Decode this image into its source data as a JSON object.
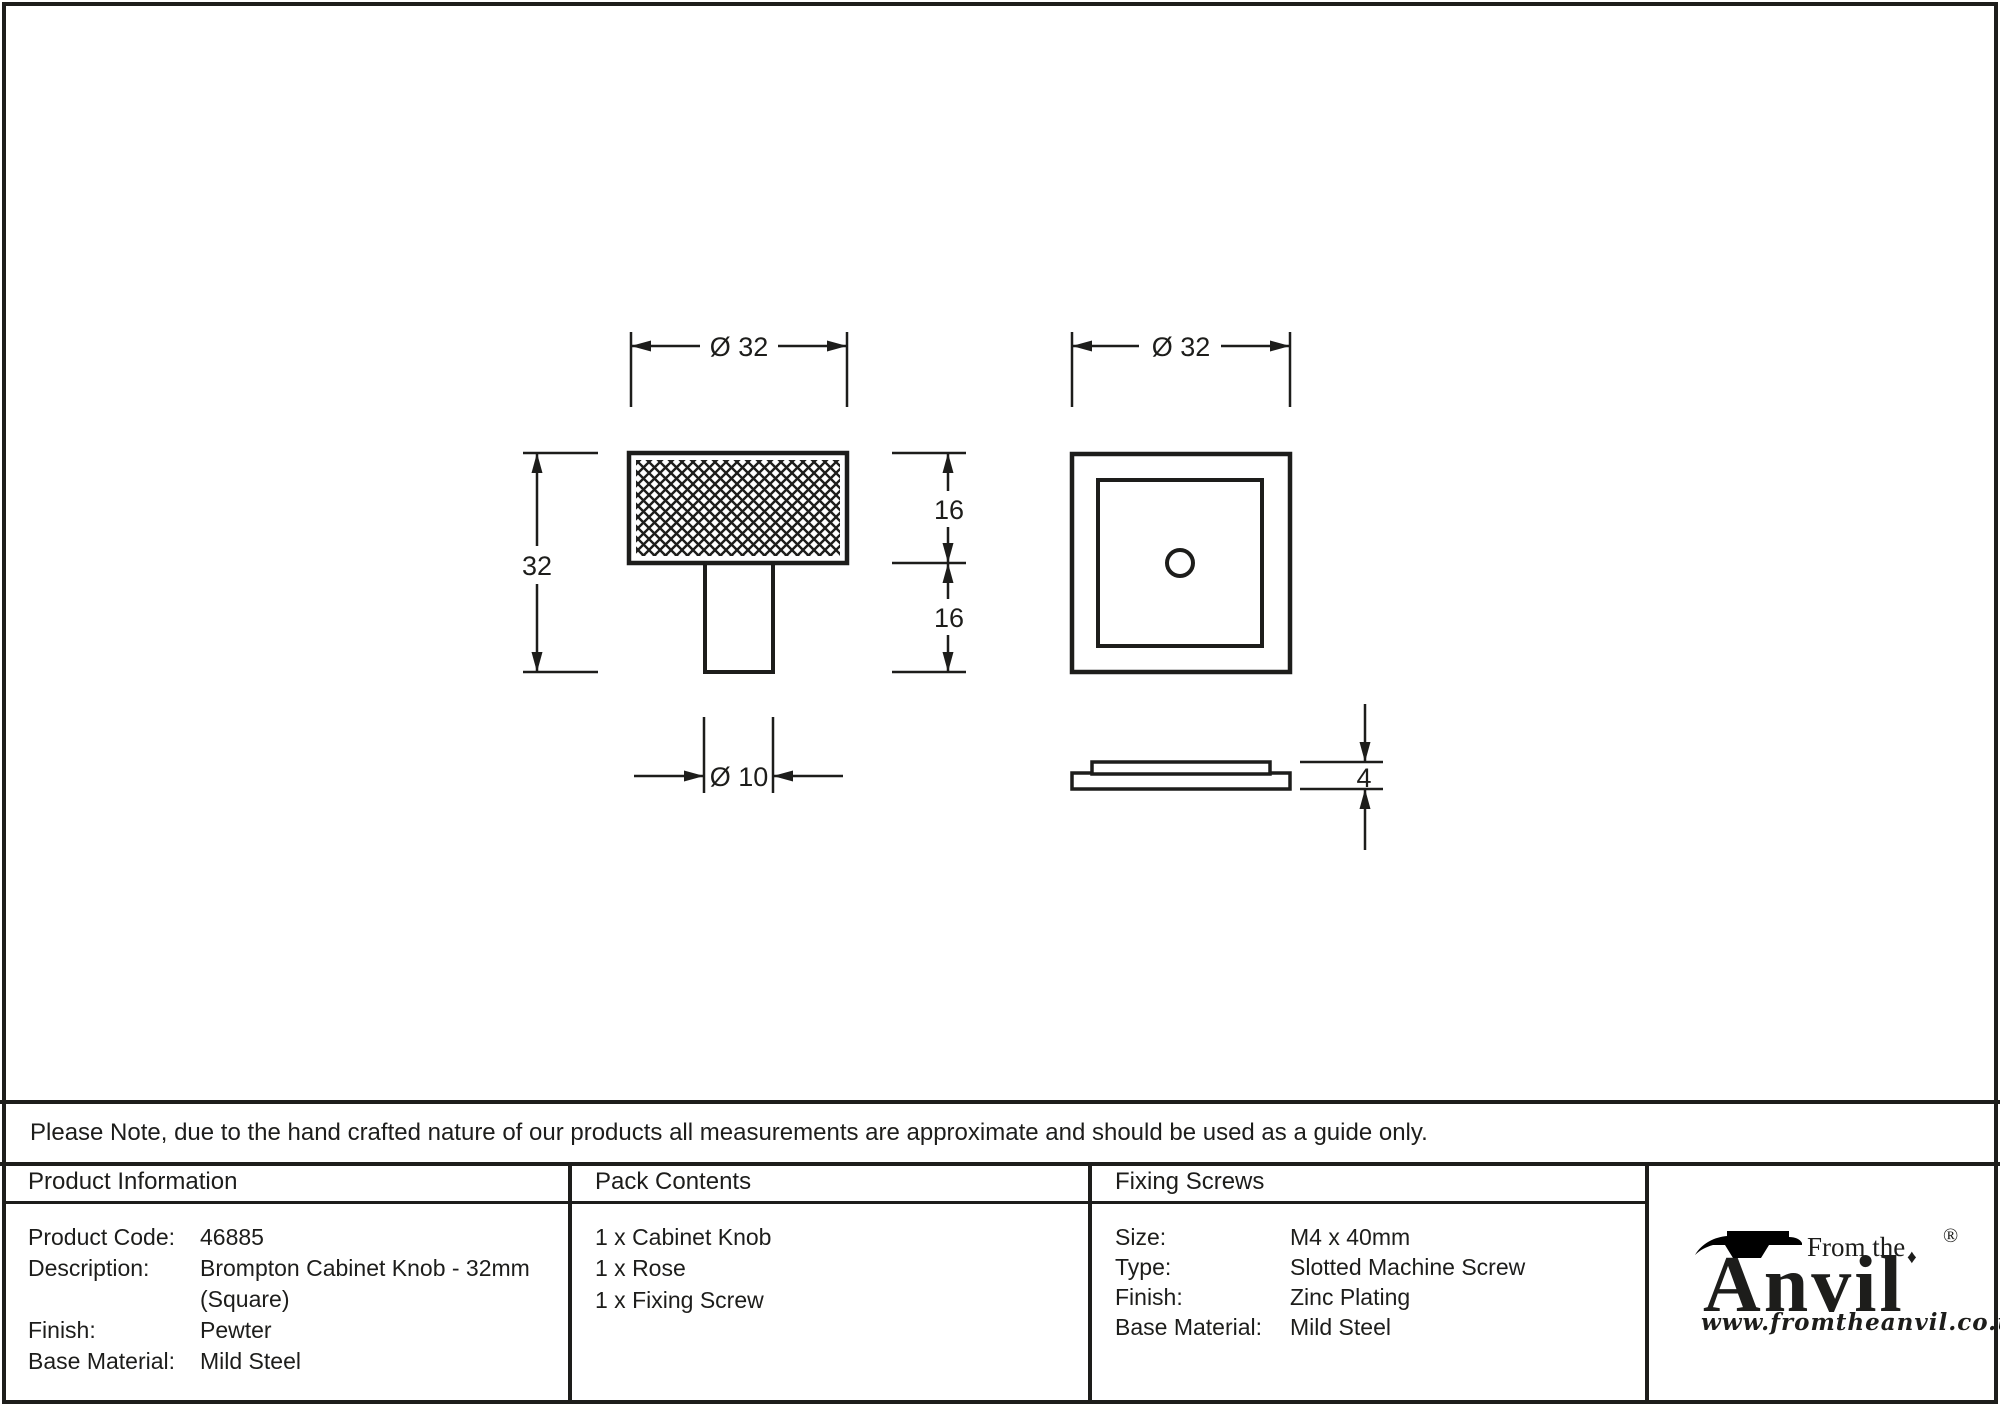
{
  "note": {
    "text": "Please Note, due to the hand crafted nature of our products all measurements are approximate and should be used as a guide only."
  },
  "drawing": {
    "knob_front": {
      "diameter_label": "Ø 32",
      "height_label": "32",
      "head_height_label": "16",
      "stem_height_label": "16",
      "stem_diameter_label": "Ø 10"
    },
    "rose_front": {
      "diameter_label": "Ø 32"
    },
    "rose_side": {
      "thickness_label": "4"
    }
  },
  "table": {
    "product_information": {
      "header": "Product Information",
      "rows": [
        {
          "label": "Product Code:",
          "value": "46885"
        },
        {
          "label": "Description:",
          "value": "Brompton Cabinet Knob - 32mm"
        },
        {
          "label": "",
          "value": "(Square)"
        },
        {
          "label": "Finish:",
          "value": "Pewter"
        },
        {
          "label": "Base Material:",
          "value": "Mild Steel"
        }
      ]
    },
    "pack_contents": {
      "header": "Pack Contents",
      "items": [
        "1 x Cabinet Knob",
        "1 x Rose",
        "1 x Fixing Screw"
      ]
    },
    "fixing_screws": {
      "header": "Fixing Screws",
      "rows": [
        {
          "label": "Size:",
          "value": "M4 x 40mm"
        },
        {
          "label": "Type:",
          "value": "Slotted Machine Screw"
        },
        {
          "label": "Finish:",
          "value": "Zinc Plating"
        },
        {
          "label": "Base Material:",
          "value": "Mild Steel"
        }
      ]
    }
  },
  "logo": {
    "tagline": "From the",
    "brand": "Anvil",
    "registered_mark": "®",
    "diamond": "♦",
    "website": "www.fromtheanvil.co.uk"
  },
  "colors": {
    "ink": "#1d1d1b",
    "background": "#ffffff"
  }
}
